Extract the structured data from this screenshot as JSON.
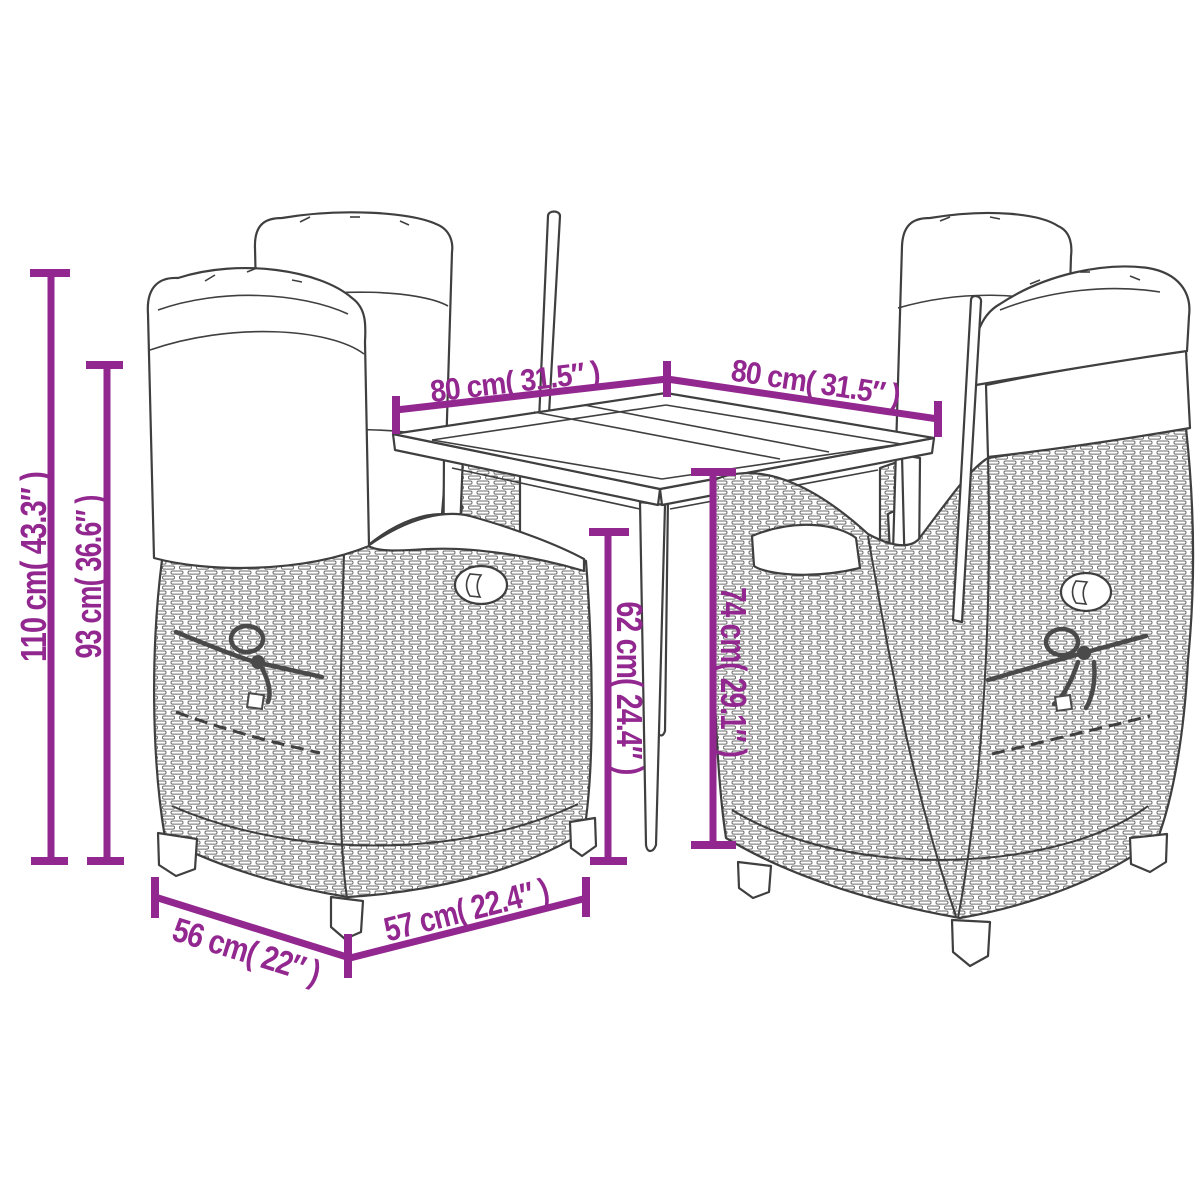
{
  "diagram_type": "product-dimension-line-drawing",
  "product": "garden dining set: 4 wicker reclining chairs and square table",
  "colors": {
    "dimension_accent": "#92278F",
    "line_art": "#3F3F3F",
    "background": "#FFFFFF"
  },
  "dims": {
    "h110": "110 cm( 43.3″ )",
    "h93": "93 cm( 36.6″ )",
    "w80l": "80 cm( 31.5″ )",
    "w80r": "80 cm( 31.5″ )",
    "h62": "62 cm( 24.4″ )",
    "h74": "74 cm( 29.1″ )",
    "d56": "56 cm( 22″ )",
    "w57": "57 cm( 22.4″ )"
  }
}
